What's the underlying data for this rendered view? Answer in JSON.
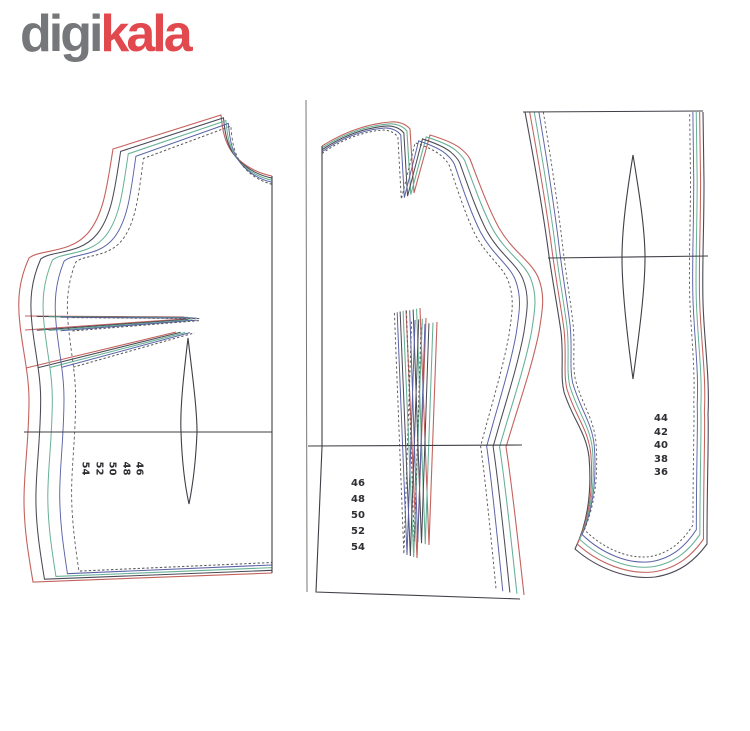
{
  "logo": {
    "part1": "digi",
    "part2": "kala"
  },
  "pattern": {
    "left_piece": {
      "sizes": [
        "54",
        "52",
        "50",
        "48",
        "46"
      ]
    },
    "middle_piece": {
      "sizes": [
        "46",
        "48",
        "50",
        "52",
        "54"
      ]
    },
    "right_piece": {
      "sizes": [
        "44",
        "42",
        "40",
        "38",
        "36"
      ]
    }
  },
  "colors": {
    "logo_gray": "#76777b",
    "logo_red": "#e2494e",
    "outline": "#3f3f46",
    "divider": "#777777",
    "left_piece_lines": [
      "#c4625d",
      "#4a4a56",
      "#67b096",
      "#5a62a6",
      "#5a5a5a"
    ],
    "middle_piece_lines": [
      "#c4625d",
      "#67b096",
      "#4a4a56",
      "#5a62a6",
      "#5a5a5a"
    ],
    "right_piece_lines": [
      "#4a4a56",
      "#c4625d",
      "#67b096",
      "#5a62a6",
      "#5a5a5a"
    ]
  }
}
